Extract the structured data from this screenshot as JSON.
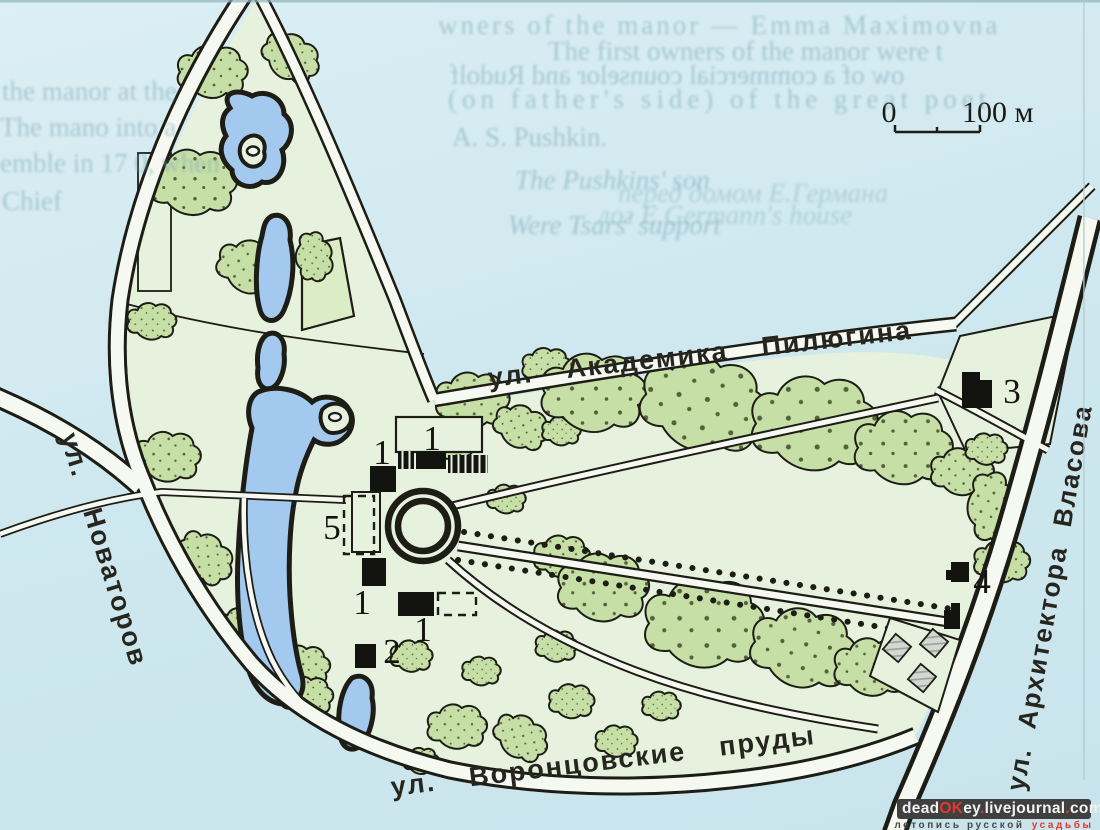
{
  "colors": {
    "page_bg": "#cfe8ef",
    "page_bg2": "#dbeff4",
    "park": "#e6f2de",
    "tree": "#c6dfa6",
    "tree_dot": "#55603a",
    "pond": "#a3c9ee",
    "ink": "#1d1d16",
    "road": "#f6f9f1",
    "red": "#e03a2e",
    "wm_bg": "#404041",
    "ghost": "#7fa9b6",
    "gray_bld": "#d4d7d2"
  },
  "map": {
    "scale_bar": {
      "zero": "0",
      "label": "100 м"
    },
    "streets": {
      "pilyugina": "ул. Академика Пилюгина",
      "vorontsovskie": "ул. Воронцовские пруды",
      "novatorov": "ул. Новаторов",
      "vlasova": "ул. Архитектора Власова"
    },
    "markers": {
      "n1": "1",
      "n2": "2",
      "n3": "3",
      "n4": "4",
      "n5": "5"
    }
  },
  "ghost_text": {
    "right": [
      "wners of the manor — Emma Maximovna",
      "The first owners of the manor were t",
      "ow of a commercial counselor and Rudolf",
      "(on father's side) of the great poet",
      "A. S. Pushkin.",
      "The Pushkins' son",
      "Were Tsars' support",
      "перед домом Е.Германа",
      "лог Е.Germann's house"
    ],
    "left": [
      "the manor   at the",
      "The mano   into a",
      "emble in 17  0, when",
      "Chief"
    ]
  },
  "watermark": {
    "parts": [
      {
        "t": "dead",
        "c": "#f2f2f2"
      },
      {
        "t": "OK",
        "c": "#e03a2e"
      },
      {
        "t": "ey",
        "c": "#f2f2f2"
      },
      {
        "t": ".",
        "c": "#e03a2e"
      },
      {
        "t": "livejournal",
        "c": "#f2f2f2"
      },
      {
        "t": ".",
        "c": "#e03a2e"
      },
      {
        "t": "com",
        "c": "#f2f2f2"
      }
    ],
    "subtitle": {
      "dark": "летопись русской",
      "red": "усадьбы"
    }
  }
}
